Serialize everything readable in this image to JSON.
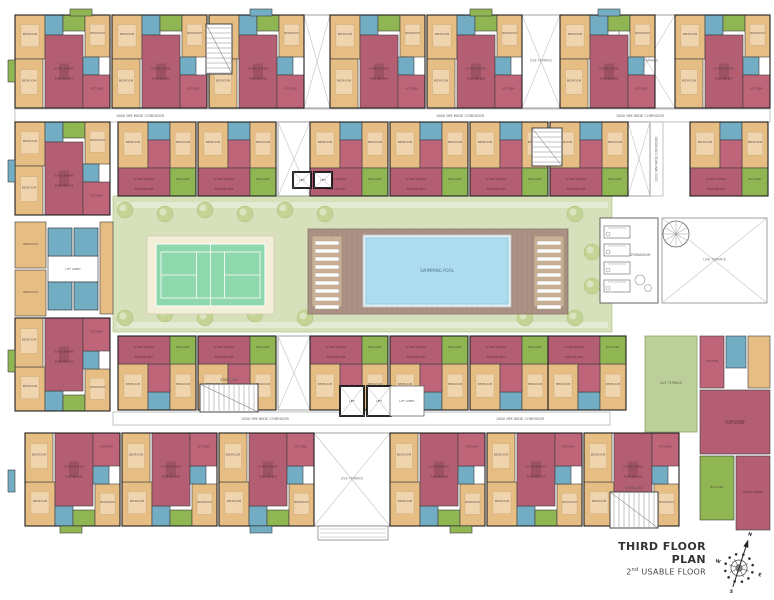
{
  "meta": {
    "title": "THIRD FLOOR PLAN",
    "subtitle_num": "2",
    "subtitle_sup": "nd",
    "subtitle_rest": " USABLE FLOOR"
  },
  "compass": {
    "directions": [
      "N",
      "E",
      "S",
      "W"
    ]
  },
  "palette": {
    "living": "#b35e72",
    "bedroom": "#e6bd82",
    "toilet": "#72adc4",
    "kitchen": "#bf6579",
    "balcony": "#8fb653",
    "wall": "#3c3c3c",
    "outline": "#1f1f1f",
    "courtyard": "#d6e0ba",
    "path": "#e4ebd3",
    "tree": "#c3d494",
    "tree_edge": "#a9bf77",
    "tennis_apron": "#f3eed8",
    "tennis_court": "#8fd7ac",
    "deck": "#ab9285",
    "deck_line": "#9a8175",
    "bench": "#c9b197",
    "pool": "#aedcef",
    "pool_edge": "#dfeef5",
    "terrace_green": "#bccf9a",
    "label": "#4a3a3a",
    "corridor_label": "#666666"
  },
  "room_labels": {
    "living": "LIVING DINING",
    "bedroom": "BEDROOM",
    "toilet": "TOILET",
    "kitchen": "KITCHEN",
    "balcony": "BALCONY"
  },
  "flat_label_prefix": "FLAT NO",
  "labels": {
    "pool": "SWIMMING POOL",
    "gym": "GYMNASIUM",
    "live_terrace": "LIVE TERRACE",
    "staircase": "STAIRCASE",
    "lift": "LIFT",
    "lift_lobby": "LIFT LOBBY",
    "corridor": "1800 MM WIDE CORRIDOR"
  },
  "modules": {
    "A": {
      "w": 95,
      "h": 93,
      "rooms": [
        [
          0,
          0,
          30,
          44,
          "bedroom"
        ],
        [
          30,
          0,
          18,
          20,
          "toilet"
        ],
        [
          48,
          0,
          22,
          16,
          "balcony"
        ],
        [
          70,
          0,
          25,
          42,
          "bedroom"
        ],
        [
          30,
          20,
          38,
          73,
          "living"
        ],
        [
          0,
          44,
          28,
          49,
          "bedroom"
        ],
        [
          68,
          42,
          16,
          18,
          "toilet"
        ],
        [
          68,
          60,
          27,
          33,
          "kitchen"
        ]
      ]
    },
    "B": {
      "w": 78,
      "h": 74,
      "rooms": [
        [
          0,
          0,
          30,
          46,
          "bedroom"
        ],
        [
          30,
          0,
          22,
          18,
          "toilet"
        ],
        [
          52,
          0,
          26,
          46,
          "bedroom"
        ],
        [
          30,
          18,
          22,
          28,
          "kitchen"
        ],
        [
          0,
          46,
          52,
          28,
          "living"
        ],
        [
          52,
          46,
          26,
          28,
          "balcony"
        ]
      ]
    }
  },
  "placements": [
    {
      "m": "A",
      "x": 15,
      "y": 15,
      "fy": false,
      "flat": "301"
    },
    {
      "m": "A",
      "x": 112,
      "y": 15,
      "fy": false,
      "flat": "302"
    },
    {
      "m": "A",
      "x": 209,
      "y": 15,
      "fy": false,
      "flat": "303"
    },
    {
      "m": "A",
      "x": 330,
      "y": 15,
      "fy": false,
      "flat": "304"
    },
    {
      "m": "A",
      "x": 427,
      "y": 15,
      "fy": false,
      "flat": "305"
    },
    {
      "m": "A",
      "x": 560,
      "y": 15,
      "fy": false,
      "flat": "306"
    },
    {
      "m": "A",
      "x": 675,
      "y": 15,
      "fy": false,
      "flat": "307"
    },
    {
      "m": "B",
      "x": 118,
      "y": 122,
      "fy": false,
      "flat": "308"
    },
    {
      "m": "B",
      "x": 198,
      "y": 122,
      "fy": false,
      "flat": "309"
    },
    {
      "m": "B",
      "x": 310,
      "y": 122,
      "fy": false,
      "flat": "310"
    },
    {
      "m": "B",
      "x": 390,
      "y": 122,
      "fy": false,
      "flat": "311"
    },
    {
      "m": "B",
      "x": 470,
      "y": 122,
      "fy": false,
      "flat": "312"
    },
    {
      "m": "B",
      "x": 550,
      "y": 122,
      "fy": false,
      "flat": "313"
    },
    {
      "m": "A",
      "x": 15,
      "y": 122,
      "fy": false,
      "flat": "314"
    },
    {
      "m": "A",
      "x": 15,
      "y": 318,
      "fy": true,
      "flat": "315"
    },
    {
      "m": "B",
      "x": 690,
      "y": 122,
      "fy": false,
      "flat": "316"
    },
    {
      "m": "B",
      "x": 118,
      "y": 336,
      "fy": true,
      "flat": "317"
    },
    {
      "m": "B",
      "x": 198,
      "y": 336,
      "fy": true,
      "flat": "318"
    },
    {
      "m": "B",
      "x": 310,
      "y": 336,
      "fy": true,
      "flat": "319"
    },
    {
      "m": "B",
      "x": 390,
      "y": 336,
      "fy": true,
      "flat": "320"
    },
    {
      "m": "B",
      "x": 470,
      "y": 336,
      "fy": true,
      "flat": "321"
    },
    {
      "m": "B",
      "x": 548,
      "y": 336,
      "fy": true,
      "flat": "322"
    },
    {
      "m": "A",
      "x": 25,
      "y": 433,
      "fy": true,
      "flat": "323"
    },
    {
      "m": "A",
      "x": 122,
      "y": 433,
      "fy": true,
      "flat": "324"
    },
    {
      "m": "A",
      "x": 219,
      "y": 433,
      "fy": true,
      "flat": "325"
    },
    {
      "m": "A",
      "x": 390,
      "y": 433,
      "fy": true,
      "flat": "326"
    },
    {
      "m": "A",
      "x": 487,
      "y": 433,
      "fy": true,
      "flat": "327"
    },
    {
      "m": "A",
      "x": 584,
      "y": 433,
      "fy": true,
      "flat": "328"
    }
  ],
  "extras": {
    "rooms": [
      [
        700,
        336,
        24,
        52,
        "kitchen"
      ],
      [
        726,
        336,
        20,
        32,
        "toilet"
      ],
      [
        748,
        336,
        22,
        52,
        "bedroom"
      ],
      [
        700,
        390,
        70,
        64,
        "living"
      ],
      [
        700,
        456,
        34,
        64,
        "balcony"
      ],
      [
        736,
        456,
        34,
        74,
        "living"
      ],
      [
        15,
        222,
        31,
        46,
        "bedroom"
      ],
      [
        15,
        270,
        31,
        46,
        "bedroom"
      ],
      [
        100,
        222,
        13,
        92,
        "bedroom"
      ]
    ],
    "flat": {
      "x": 735,
      "y": 424,
      "no": "329"
    }
  },
  "terraces": [
    {
      "x": 304,
      "y": 15,
      "w": 26,
      "h": 93
    },
    {
      "x": 522,
      "y": 15,
      "w": 38,
      "h": 93
    },
    {
      "x": 619,
      "y": 15,
      "w": 56,
      "h": 93
    },
    {
      "x": 278,
      "y": 122,
      "w": 32,
      "h": 74
    },
    {
      "x": 628,
      "y": 122,
      "w": 22,
      "h": 74
    },
    {
      "x": 278,
      "y": 336,
      "w": 32,
      "h": 74
    },
    {
      "x": 314,
      "y": 433,
      "w": 76,
      "h": 93
    },
    {
      "x": 662,
      "y": 218,
      "w": 105,
      "h": 85
    }
  ],
  "corridors": [
    {
      "x": 15,
      "y": 109,
      "w": 755,
      "h": 13,
      "v": false,
      "lx": [
        140,
        460,
        640
      ]
    },
    {
      "x": 113,
      "y": 412,
      "w": 497,
      "h": 13,
      "v": false,
      "lx": [
        265,
        520
      ]
    },
    {
      "x": 650,
      "y": 122,
      "w": 13,
      "h": 74,
      "v": true,
      "lx": [
        0
      ]
    }
  ],
  "courtyard": {
    "x": 113,
    "y": 196,
    "w": 499,
    "h": 136
  },
  "paths_y": [
    202,
    322
  ],
  "tennis": {
    "apron": {
      "x": 147,
      "y": 236,
      "w": 127,
      "h": 78
    },
    "court": {
      "x": 156,
      "y": 244,
      "w": 109,
      "h": 62
    }
  },
  "pool_area": {
    "deck": {
      "x": 308,
      "y": 229,
      "w": 260,
      "h": 85
    },
    "pool": {
      "x": 366,
      "y": 238,
      "w": 142,
      "h": 66
    },
    "benches": [
      [
        312,
        236,
        30,
        71
      ],
      [
        534,
        236,
        30,
        71
      ]
    ]
  },
  "gym": {
    "x": 600,
    "y": 218,
    "w": 58,
    "h": 85,
    "machines": 4
  },
  "spiral_stair": {
    "cx": 676,
    "cy": 234,
    "r": 13
  },
  "green_terrace": {
    "x": 645,
    "y": 336,
    "w": 52,
    "h": 96
  },
  "stairs": [
    {
      "x": 206,
      "y": 24,
      "w": 26,
      "h": 50,
      "label": false
    },
    {
      "x": 532,
      "y": 128,
      "w": 30,
      "h": 38,
      "label": false
    },
    {
      "x": 200,
      "y": 384,
      "w": 58,
      "h": 28,
      "label": true
    },
    {
      "x": 610,
      "y": 492,
      "w": 48,
      "h": 36,
      "label": true
    }
  ],
  "lift_banks": [
    {
      "x": 340,
      "y": 386,
      "shafts": 2,
      "sw": 24,
      "sh": 30
    },
    {
      "x": 293,
      "y": 172,
      "shafts": 2,
      "sw": 18,
      "sh": 16
    }
  ],
  "lobbies": [
    {
      "x": 48,
      "y": 256,
      "w": 50,
      "h": 26
    },
    {
      "x": 390,
      "y": 386,
      "w": 34,
      "h": 30
    }
  ],
  "lobby_toilets": [
    [
      48,
      228,
      24,
      28
    ],
    [
      74,
      228,
      24,
      28
    ],
    [
      48,
      282,
      24,
      28
    ],
    [
      74,
      282,
      24,
      28
    ]
  ],
  "trees": [
    [
      125,
      210
    ],
    [
      165,
      214
    ],
    [
      205,
      210
    ],
    [
      245,
      214
    ],
    [
      285,
      210
    ],
    [
      325,
      214
    ],
    [
      575,
      214
    ],
    [
      592,
      252
    ],
    [
      592,
      286
    ],
    [
      125,
      318
    ],
    [
      165,
      314
    ],
    [
      205,
      318
    ],
    [
      255,
      314
    ],
    [
      305,
      318
    ],
    [
      525,
      318
    ],
    [
      575,
      318
    ]
  ],
  "bumps": [
    [
      70,
      9,
      22,
      7,
      "balcony"
    ],
    [
      250,
      9,
      22,
      7,
      "toilet"
    ],
    [
      470,
      9,
      22,
      7,
      "balcony"
    ],
    [
      598,
      9,
      22,
      7,
      "toilet"
    ],
    [
      60,
      526,
      22,
      7,
      "balcony"
    ],
    [
      250,
      526,
      22,
      7,
      "toilet"
    ],
    [
      450,
      526,
      22,
      7,
      "balcony"
    ],
    [
      8,
      60,
      7,
      22,
      "balcony"
    ],
    [
      8,
      160,
      7,
      22,
      "toilet"
    ],
    [
      8,
      350,
      7,
      22,
      "balcony"
    ],
    [
      8,
      470,
      7,
      22,
      "toilet"
    ]
  ],
  "porch": {
    "x": 318,
    "y": 526,
    "w": 70,
    "h": 14
  }
}
